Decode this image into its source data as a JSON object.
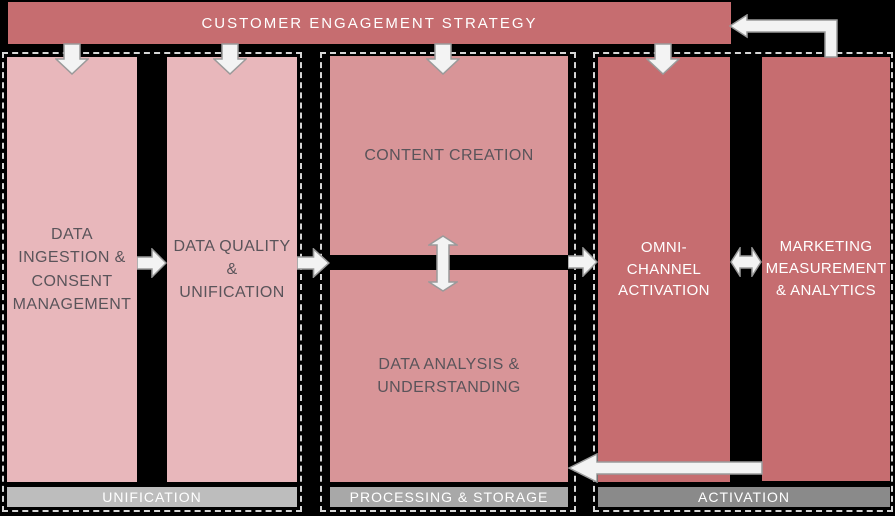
{
  "banner": {
    "label": "CUSTOMER ENGAGEMENT STRATEGY"
  },
  "groups": [
    {
      "footer": "UNIFICATION",
      "boxes": [
        {
          "label": "DATA INGESTION & CONSENT MANAGEMENT"
        },
        {
          "label": "DATA QUALITY & UNIFICATION"
        }
      ]
    },
    {
      "footer": "PROCESSING & STORAGE",
      "boxes": [
        {
          "label": "CONTENT CREATION"
        },
        {
          "label": "DATA ANALYSIS & UNDERSTANDING"
        }
      ]
    },
    {
      "footer": "ACTIVATION",
      "boxes": [
        {
          "label": "OMNI-CHANNEL ACTIVATION"
        },
        {
          "label": "MARKETING MEASUREMENT & ANALYTICS"
        }
      ]
    }
  ],
  "connections": [
    {
      "from": "CUSTOMER ENGAGEMENT STRATEGY",
      "to": "DATA INGESTION & CONSENT MANAGEMENT",
      "type": "arrow-down"
    },
    {
      "from": "CUSTOMER ENGAGEMENT STRATEGY",
      "to": "DATA QUALITY & UNIFICATION",
      "type": "arrow-down"
    },
    {
      "from": "CUSTOMER ENGAGEMENT STRATEGY",
      "to": "CONTENT CREATION",
      "type": "arrow-down"
    },
    {
      "from": "CUSTOMER ENGAGEMENT STRATEGY",
      "to": "OMNI-CHANNEL ACTIVATION",
      "type": "arrow-down"
    },
    {
      "from": "DATA INGESTION & CONSENT MANAGEMENT",
      "to": "DATA QUALITY & UNIFICATION",
      "type": "arrow-right"
    },
    {
      "from": "DATA QUALITY & UNIFICATION",
      "to": "PROCESSING & STORAGE group",
      "type": "arrow-right"
    },
    {
      "from": "CONTENT CREATION",
      "to": "DATA ANALYSIS & UNDERSTANDING",
      "type": "arrow-both-vertical"
    },
    {
      "from": "PROCESSING & STORAGE group",
      "to": "OMNI-CHANNEL ACTIVATION",
      "type": "arrow-right"
    },
    {
      "from": "OMNI-CHANNEL ACTIVATION",
      "to": "MARKETING MEASUREMENT & ANALYTICS",
      "type": "arrow-both-horizontal"
    },
    {
      "from": "MARKETING MEASUREMENT & ANALYTICS",
      "to": "DATA ANALYSIS & UNDERSTANDING",
      "type": "arrow-left-return"
    },
    {
      "from": "MARKETING MEASUREMENT & ANALYTICS",
      "to": "CUSTOMER ENGAGEMENT STRATEGY",
      "type": "arrow-up-left-feedback"
    }
  ],
  "colors": {
    "background": "#000000",
    "banner_bg": "#c66d70",
    "light_pink_box": "#e8b7bb",
    "mid_pink_box": "#d89598",
    "dark_rose_box": "#c66d70",
    "box_text_dark": "#5a545a",
    "box_text_light": "#ffffff",
    "bar_unification": "#bdbdbd",
    "bar_processing": "#a8a8a8",
    "bar_activation": "#8a8a8a",
    "arrow_fill": "#f3f3f3",
    "arrow_stroke": "#9a9a9a",
    "dashed_border": "#d6d6d6"
  }
}
